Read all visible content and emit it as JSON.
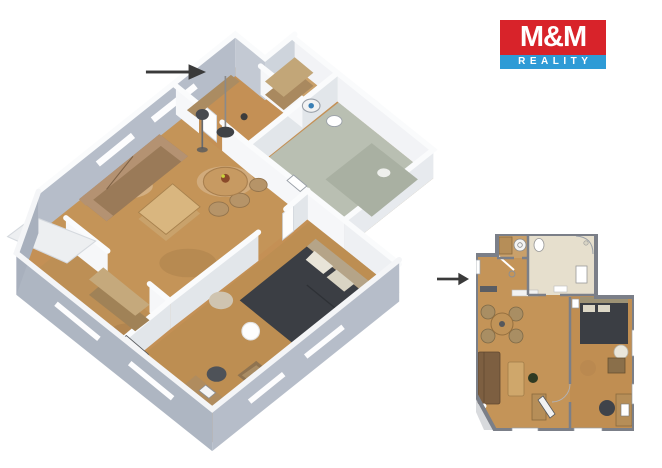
{
  "logo": {
    "title": "M&M",
    "subtitle": "REALITY",
    "title_bg": "#d8232a",
    "subtitle_bg": "#2e9bd6",
    "text_color": "#ffffff"
  },
  "palette": {
    "background": "#ffffff",
    "arrow": "#3a3a3a",
    "floor_wood": "#c49458",
    "floor_wood_dark": "#bd8e52",
    "floor_tile": "#b9bfb2",
    "wall_inner_white": "#f2f3f6",
    "wall_exterior_gray": "#b4bbc7",
    "plan2d_wall_gray": "#7b7f88",
    "plan2d_tile": "#e6dfcd",
    "bed_dark": "#3b3e44",
    "sofa_brown": "#9a7a58"
  }
}
